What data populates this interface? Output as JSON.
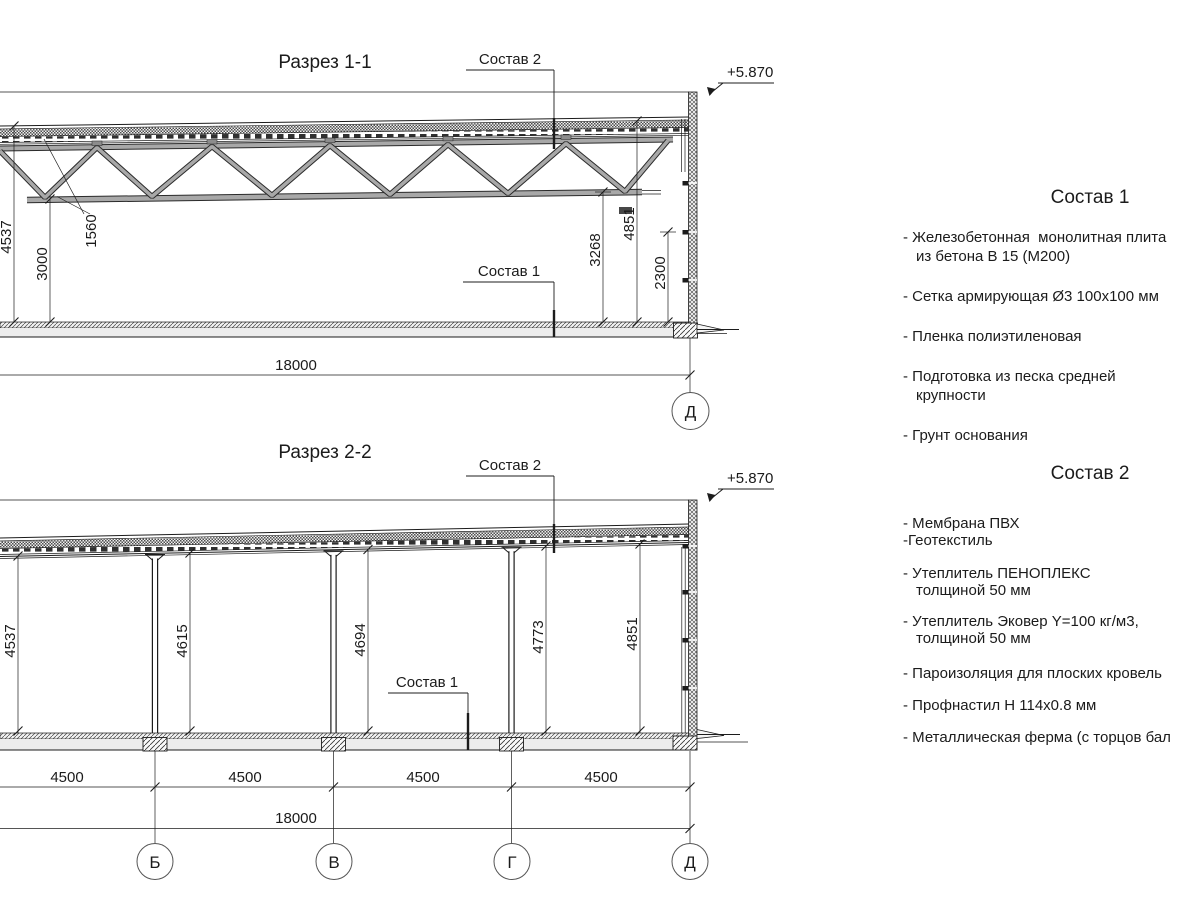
{
  "section1": {
    "title": "Разрез 1-1",
    "label_sostav2": "Состав 2",
    "label_sostav1": "Состав 1",
    "elevation": "+5.870",
    "dims": {
      "d4537": "4537",
      "d1560": "1560",
      "d3000": "3000",
      "d3268": "3268",
      "d4851": "4851",
      "d2300": "2300",
      "d18000": "18000"
    },
    "axis_d": "Д"
  },
  "section2": {
    "title": "Разрез 2-2",
    "label_sostav2": "Состав 2",
    "label_sostav1": "Состав 1",
    "elevation": "+5.870",
    "dims": {
      "d4537": "4537",
      "d4615": "4615",
      "d4694": "4694",
      "d4773": "4773",
      "d4851": "4851",
      "d18000": "18000",
      "bays": [
        "4500",
        "4500",
        "4500",
        "4500"
      ]
    },
    "axes": [
      "Б",
      "В",
      "Г",
      "Д"
    ]
  },
  "lists": {
    "sostav1": {
      "title": "Состав 1",
      "items": [
        "- Железобетонная  монолитная плита\nиз бетона В 15 (М200)",
        "- Сетка армирующая Ø3 100x100 мм",
        "- Пленка полиэтиленовая",
        "- Подготовка из песка средней\nкрупности",
        "- Грунт основания"
      ]
    },
    "sostav2": {
      "title": "Состав 2",
      "items": [
        "- Мембрана ПВХ\n-Геотекстиль",
        "- Утеплитель ПЕНОПЛЕКС\nтолщиной 50 мм",
        "- Утеплитель Эковер Y=100 кг/м3,\nтолщиной 50 мм",
        "- Пароизоляция для плоских кровель",
        "- Профнастил Н 114х0.8 мм",
        "- Металлическая ферма (с торцов бал"
      ]
    }
  },
  "colors": {
    "ink": "#1c1c1c",
    "member_gray": "#a8a8a8",
    "floor_band": "#ededed"
  }
}
